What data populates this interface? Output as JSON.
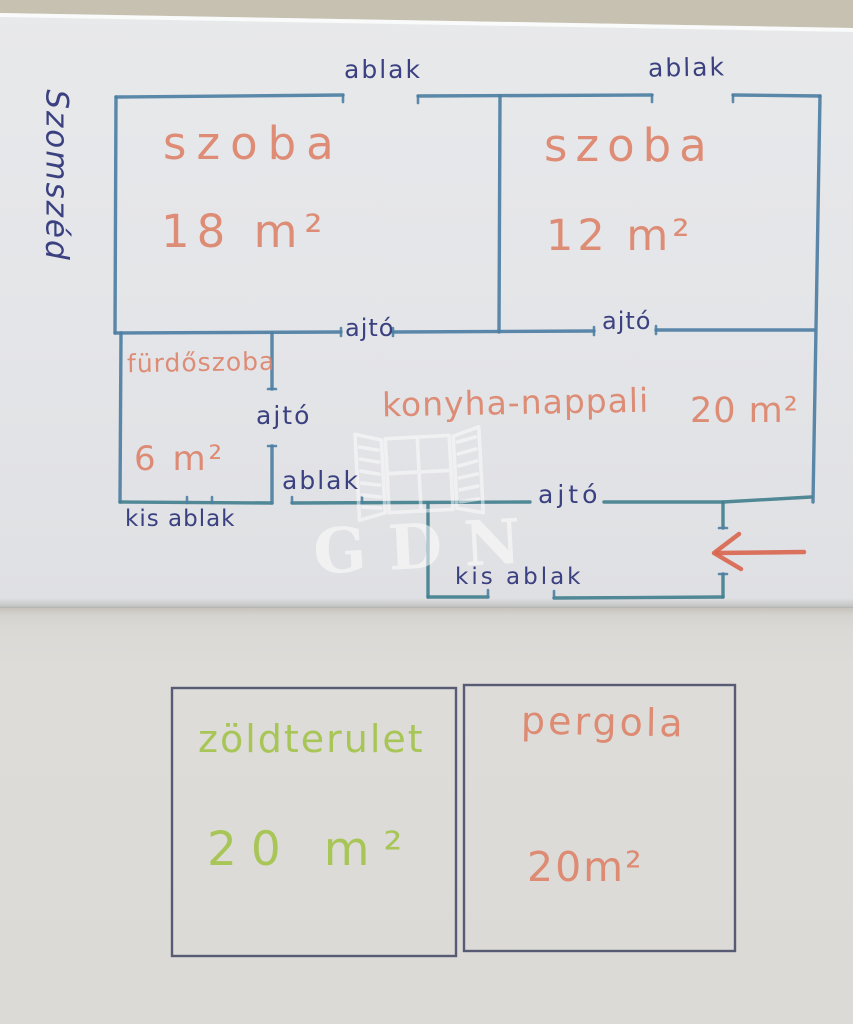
{
  "watermark": {
    "text": "GDN"
  },
  "neighbor_label": "Szomszéd",
  "plan": {
    "rooms": [
      {
        "id": "room1",
        "name": "szoba",
        "area": "18 m²"
      },
      {
        "id": "room2",
        "name": "szoba",
        "area": "12 m²"
      },
      {
        "id": "bathroom",
        "name": "fürdőszoba",
        "area": "6 m²"
      },
      {
        "id": "kitchen",
        "name": "konyha-nappali",
        "area": "20 m²"
      }
    ],
    "openings": {
      "window": "ablak",
      "door": "ajtó",
      "small_window": "kis ablak"
    }
  },
  "outdoor": [
    {
      "id": "green_area",
      "name": "zöldterulet",
      "area": "20 m²"
    },
    {
      "id": "pergola",
      "name": "pergola",
      "area": "20m²"
    }
  ],
  "colors": {
    "background": "#c7c1b1",
    "paper-top": "#e5e6e9",
    "paper-bottom": "#dddbd8",
    "wall": "#4e7fa3",
    "wall-dark": "#43808f",
    "ink": "#3b4180",
    "room-label": "#dd8066",
    "green-label": "#a6c551",
    "outdoor-box": "#4f536e",
    "arrow": "#d9654e",
    "watermark": "#ffffff"
  }
}
